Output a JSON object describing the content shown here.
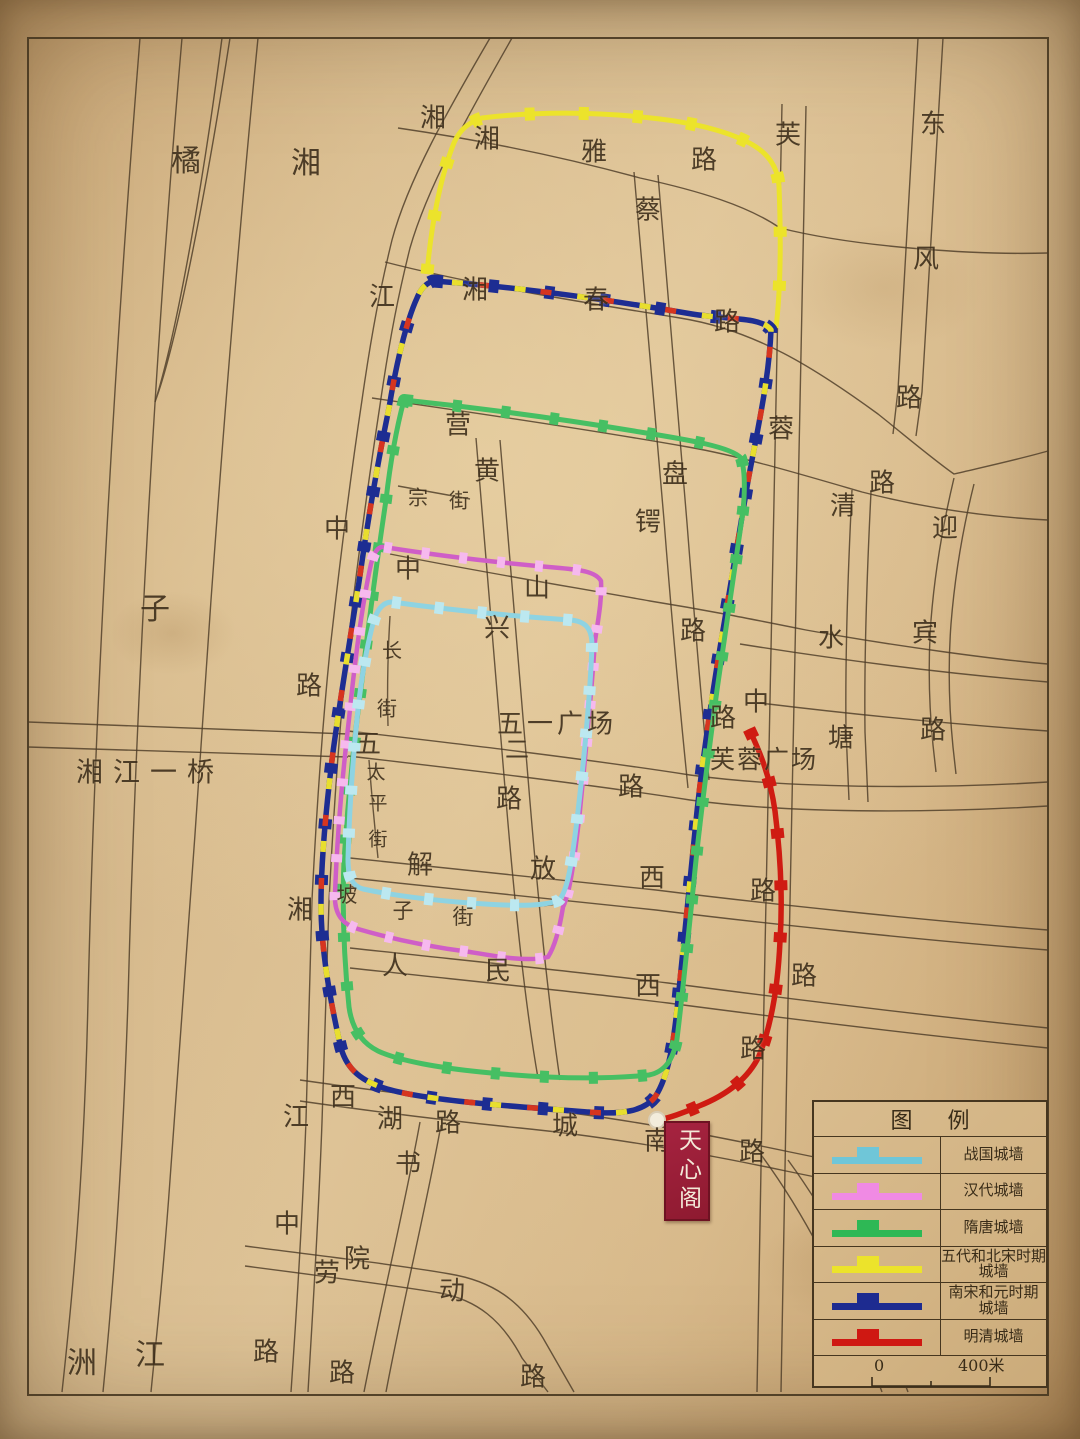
{
  "legend": {
    "title": "图  例",
    "items": [
      {
        "label": "战国城墙",
        "label2": "",
        "color": "#6fc6d8"
      },
      {
        "label": "汉代城墙",
        "label2": "",
        "color": "#f08ae4"
      },
      {
        "label": "隋唐城墙",
        "label2": "",
        "color": "#2eb855"
      },
      {
        "label": "五代和北宋时期",
        "label2": "城墙",
        "color": "#ece32b"
      },
      {
        "label": "南宋和元时期",
        "label2": "城墙",
        "color": "#1d2b90"
      },
      {
        "label": "明清城墙",
        "label2": "",
        "color": "#cf1812"
      }
    ],
    "scale": {
      "zero": "0",
      "max": "400米"
    }
  },
  "landmark": {
    "name": "天心阁"
  },
  "map": {
    "walls": [
      {
        "name": "five-dynasties-north-song",
        "color": "#ece32b",
        "bw": 5,
        "teeth": {
          "c": "#ece32b",
          "w": 13,
          "dash": "10 44"
        },
        "d": "M427,274 C431,226 440,180 452,148 C457,133 466,123 482,118 C540,111 602,112 660,119 C702,124 740,135 759,149 C771,158 778,170 779,186 C781,236 781,286 776,328"
      },
      {
        "name": "south-song-yuan",
        "color": "#1d2d92",
        "bw": 5.5,
        "teeth": {
          "c": "#1d2d92",
          "w": 13,
          "dash": "10 46"
        },
        "overlays": [
          {
            "c": "#d6351f",
            "w": 5.5,
            "dash": "11 52",
            "off": 18
          },
          {
            "c": "#e8de2e",
            "w": 5.5,
            "dash": "11 52",
            "off": 44
          }
        ],
        "d": "M433,281 C520,287 610,300 692,314 C731,320 762,317 771,330 C769,380 757,432 748,481 C738,540 728,600 718,660 C710,710 702,762 696,821 C690,880 684,940 678,1000 C674,1040 669,1076 655,1097 C644,1111 622,1115 588,1112 C506,1106 421,1100 384,1088 C359,1080 345,1067 340,1044 C330,999 321,950 321,904 C321,858 327,800 333,752 C340,700 350,640 359,582 C367,525 377,466 389,408 C396,365 406,322 417,298 C421,288 427,283 433,281 Z"
      },
      {
        "name": "sui-tang",
        "color": "#46bf63",
        "bw": 5,
        "teeth": {
          "c": "#46bf63",
          "w": 12,
          "dash": "9 40"
        },
        "d": "M404,400 C480,408 562,419 640,432 C690,440 731,447 741,458 C745,470 745,490 743,511 C735,570 726,630 717,690 C709,750 701,810 695,870 C689,930 683,990 677,1039 C673,1061 664,1072 649,1075 C600,1080 540,1078 481,1072 C441,1068 399,1061 378,1051 C362,1043 352,1029 349,1007 C344,959 342,910 344,860 C348,800 354,740 362,680 C369,620 377,560 386,500 C390,465 396,430 404,400 Z"
      },
      {
        "name": "han",
        "color": "#cf5ec7",
        "bw": 4.5,
        "teeth": {
          "c": "#f6b9ee",
          "w": 11,
          "dash": "8 30"
        },
        "d": "M384,547 C440,556 502,563 560,568 C582,570 596,572 601,581 C602,601 598,620 595,641 C591,700 585,760 579,820 C574,861 570,893 563,907 C560,926 555,946 548,957 C528,962 500,957 470,952 C430,947 392,939 358,929 C342,924 334,914 335,894 C337,839 342,779 349,719 C355,659 363,600 371,564 C374,552 378,546 384,547 Z"
      },
      {
        "name": "warring-states",
        "color": "#8ed3e2",
        "bw": 5,
        "teeth": {
          "c": "#bce8f0",
          "w": 12,
          "dash": "9 34"
        },
        "d": "M392,602 C450,610 512,616 570,620 C585,621 592,628 592,645 C590,700 584,760 577,820 C572,860 568,891 559,900 C545,907 510,906 470,903 C430,900 391,895 363,889 C352,886 348,877 348,859 C349,819 352,769 357,719 C361,679 367,645 374,620 C378,608 384,602 392,602 Z"
      },
      {
        "name": "ming-qing",
        "color": "#cf1b12",
        "bw": 5.5,
        "teeth": {
          "c": "#cf1b12",
          "w": 13,
          "dash": "10 42"
        },
        "d": "M749,729 C760,752 770,776 775,811 C780,851 783,896 780,941 C778,986 771,1026 759,1056 C747,1081 724,1096 699,1106 C684,1113 668,1118 659,1120"
      }
    ],
    "roads": [
      "M140,38 C115,350 95,700 88,1000 C84,1180 72,1300 62,1392",
      "M182,38 C155,350 136,700 128,1000 C122,1180 112,1300 103,1392",
      "M222,38 C205,170 178,330 155,402 C178,340 208,180 230,38",
      "M258,38 C240,220 224,420 211,600 C198,790 184,1000 170,1180 C163,1280 156,1340 151,1392",
      "M490,38 C448,110 408,180 392,240 C381,285 372,330 362,400 C350,480 340,560 330,650 C322,730 316,820 312,900 C309,990 308,1060 306,1120 C302,1230 296,1320 291,1392",
      "M512,38 C470,112 428,185 410,248 C399,292 390,336 380,405 C368,484 357,564 347,653 C339,733 333,822 329,902 C326,992 324,1062 322,1122 C318,1232 312,1322 308,1392",
      "M28,722 L348,734",
      "M28,747 L348,757",
      "M398,128 C480,140 560,156 640,178 C700,191 748,206 780,228 C860,248 980,255 1048,253",
      "M385,262 C470,284 580,302 680,318 C755,330 815,368 878,414 C908,438 934,460 954,474 C988,466 1020,459 1048,451",
      "M372,398 C470,412 580,428 688,447 C740,456 800,474 862,492 C940,512 1008,518 1048,520",
      "M390,554 C470,570 560,585 650,601 C706,610 746,618 806,630 C900,647 1000,660 1048,664",
      "M740,644 C840,660 950,674 1048,682",
      "M348,731 C460,744 580,758 690,775 C800,790 950,788 1048,782",
      "M348,756 C460,769 580,783 690,800 C800,815 950,812 1048,806",
      "M350,858 C460,870 560,880 656,890 C760,903 920,920 1048,930",
      "M350,878 C460,890 560,900 656,910 C760,923 920,940 1048,950",
      "M350,948 C470,961 580,972 668,983 C790,999 930,1016 1048,1028",
      "M350,968 C470,981 580,992 668,1003 C790,1019 930,1036 1048,1048",
      "M300,1080 C370,1090 450,1100 520,1107 C610,1116 700,1133 790,1152 C910,1177 1000,1192 1048,1200",
      "M300,1101 C370,1111 450,1121 520,1128 C610,1137 696,1152 786,1171 C906,1196 1000,1212 1048,1220",
      "M245,1246 C330,1257 405,1266 450,1274 C492,1281 520,1300 543,1338 L574,1392",
      "M245,1266 C330,1277 398,1286 440,1293 C477,1300 502,1320 522,1358 L548,1392",
      "M762,1156 C800,1208 840,1278 882,1392",
      "M788,1160 C826,1212 866,1282 908,1392",
      "M476,438 C486,560 496,680 506,800 C516,920 526,1010 538,1078",
      "M500,440 C510,562 520,682 530,802 C540,922 550,1012 560,1080",
      "M634,172 C644,290 654,405 664,520 C671,610 679,700 688,788",
      "M658,175 C668,293 678,408 687,523 C694,613 701,698 709,780",
      "M782,104 C779,250 776,400 773,550 C770,700 767,850 764,1000 C762,1150 759,1290 757,1392",
      "M806,106 C803,252 800,402 797,552 C794,702 791,852 788,1002 C786,1152 783,1292 781,1392",
      "M918,38 C912,140 905,260 898,390 L893,434",
      "M943,38 C937,140 930,260 922,392 L916,436",
      "M852,490 C848,570 845,650 846,730 L849,800",
      "M871,492 C867,572 864,652 865,732 L868,802",
      "M954,478 C944,520 935,570 931,620 C928,662 929,705 933,745 L936,772",
      "M974,484 C964,524 955,574 951,624 C948,664 949,707 953,747 L956,774",
      "M398,486 L470,499",
      "M390,616 C388,650 387,690 388,726",
      "M369,760 C372,800 375,830 378,858",
      "M350,886 C395,896 445,902 495,905 C520,907 542,907 556,904",
      "M760,703 C850,714 950,724 1048,731",
      "M420,1122 C406,1200 382,1300 364,1392",
      "M441,1125 C427,1203 403,1302 386,1392"
    ],
    "labels": [
      {
        "t": "橘",
        "x": 186,
        "y": 158,
        "s": 30
      },
      {
        "t": "湘",
        "x": 306,
        "y": 160,
        "s": 30
      },
      {
        "t": "子",
        "x": 155,
        "y": 606,
        "s": 30
      },
      {
        "t": "洲",
        "x": 82,
        "y": 1360,
        "s": 30
      },
      {
        "t": "江",
        "x": 150,
        "y": 1352,
        "s": 30
      },
      {
        "t": "湘江一桥",
        "x": 150,
        "y": 770,
        "s": 27,
        "ls": 10
      },
      {
        "t": "湘",
        "x": 433,
        "y": 116
      },
      {
        "t": "江",
        "x": 382,
        "y": 295
      },
      {
        "t": "中",
        "x": 337,
        "y": 527
      },
      {
        "t": "路",
        "x": 309,
        "y": 684
      },
      {
        "t": "湘",
        "x": 300,
        "y": 908
      },
      {
        "t": "江",
        "x": 296,
        "y": 1115
      },
      {
        "t": "中",
        "x": 287,
        "y": 1222
      },
      {
        "t": "路",
        "x": 266,
        "y": 1350
      },
      {
        "t": "湘",
        "x": 487,
        "y": 137
      },
      {
        "t": "雅",
        "x": 594,
        "y": 150
      },
      {
        "t": "路",
        "x": 704,
        "y": 158
      },
      {
        "t": "蔡",
        "x": 648,
        "y": 208
      },
      {
        "t": "锷",
        "x": 648,
        "y": 520
      },
      {
        "t": "路",
        "x": 693,
        "y": 629
      },
      {
        "t": "湘",
        "x": 475,
        "y": 288
      },
      {
        "t": "春",
        "x": 596,
        "y": 298
      },
      {
        "t": "路",
        "x": 727,
        "y": 320
      },
      {
        "t": "芙",
        "x": 788,
        "y": 133
      },
      {
        "t": "蓉",
        "x": 781,
        "y": 427
      },
      {
        "t": "路",
        "x": 882,
        "y": 481
      },
      {
        "t": "东",
        "x": 933,
        "y": 122
      },
      {
        "t": "风",
        "x": 926,
        "y": 257
      },
      {
        "t": "路",
        "x": 909,
        "y": 396
      },
      {
        "t": "营",
        "x": 458,
        "y": 423
      },
      {
        "t": "盘",
        "x": 675,
        "y": 472
      },
      {
        "t": "宗",
        "x": 418,
        "y": 496,
        "s": 20
      },
      {
        "t": "街",
        "x": 459,
        "y": 499,
        "s": 20
      },
      {
        "t": "中",
        "x": 408,
        "y": 567
      },
      {
        "t": "山",
        "x": 537,
        "y": 586
      },
      {
        "t": "长",
        "x": 392,
        "y": 649,
        "s": 20
      },
      {
        "t": "街",
        "x": 387,
        "y": 707,
        "s": 20
      },
      {
        "t": "黄",
        "x": 487,
        "y": 469
      },
      {
        "t": "兴",
        "x": 497,
        "y": 626
      },
      {
        "t": "清",
        "x": 843,
        "y": 504
      },
      {
        "t": "水",
        "x": 831,
        "y": 636
      },
      {
        "t": "塘",
        "x": 841,
        "y": 736
      },
      {
        "t": "迎",
        "x": 945,
        "y": 526
      },
      {
        "t": "宾",
        "x": 925,
        "y": 631
      },
      {
        "t": "路",
        "x": 933,
        "y": 728
      },
      {
        "t": "五一广场",
        "x": 557,
        "y": 722,
        "s": 26,
        "ls": 4
      },
      {
        "t": "二",
        "x": 517,
        "y": 747,
        "s": 24
      },
      {
        "t": "五",
        "x": 368,
        "y": 742
      },
      {
        "t": "路",
        "x": 509,
        "y": 797
      },
      {
        "t": "路",
        "x": 631,
        "y": 785
      },
      {
        "t": "芙蓉广场",
        "x": 764,
        "y": 758,
        "s": 25,
        "ls": 2
      },
      {
        "t": "中",
        "x": 756,
        "y": 700
      },
      {
        "t": "路",
        "x": 723,
        "y": 716
      },
      {
        "t": "太",
        "x": 376,
        "y": 771,
        "s": 19
      },
      {
        "t": "平",
        "x": 378,
        "y": 802,
        "s": 19
      },
      {
        "t": "街",
        "x": 378,
        "y": 838,
        "s": 19
      },
      {
        "t": "解",
        "x": 420,
        "y": 863
      },
      {
        "t": "放",
        "x": 543,
        "y": 867
      },
      {
        "t": "西",
        "x": 652,
        "y": 876
      },
      {
        "t": "坡",
        "x": 347,
        "y": 894,
        "s": 21
      },
      {
        "t": "子",
        "x": 403,
        "y": 910,
        "s": 21
      },
      {
        "t": "街",
        "x": 463,
        "y": 916,
        "s": 21
      },
      {
        "t": "人",
        "x": 395,
        "y": 964
      },
      {
        "t": "民",
        "x": 498,
        "y": 969
      },
      {
        "t": "西",
        "x": 648,
        "y": 984
      },
      {
        "t": "路",
        "x": 763,
        "y": 889
      },
      {
        "t": "路",
        "x": 804,
        "y": 974
      },
      {
        "t": "路",
        "x": 753,
        "y": 1047
      },
      {
        "t": "西",
        "x": 343,
        "y": 1095
      },
      {
        "t": "湖",
        "x": 390,
        "y": 1117
      },
      {
        "t": "路",
        "x": 448,
        "y": 1121
      },
      {
        "t": "城",
        "x": 565,
        "y": 1124
      },
      {
        "t": "南",
        "x": 657,
        "y": 1139
      },
      {
        "t": "路",
        "x": 752,
        "y": 1150
      },
      {
        "t": "书",
        "x": 408,
        "y": 1162
      },
      {
        "t": "院",
        "x": 357,
        "y": 1257
      },
      {
        "t": "劳",
        "x": 327,
        "y": 1271
      },
      {
        "t": "动",
        "x": 452,
        "y": 1289
      },
      {
        "t": "路",
        "x": 342,
        "y": 1371
      },
      {
        "t": "路",
        "x": 533,
        "y": 1375
      }
    ]
  }
}
